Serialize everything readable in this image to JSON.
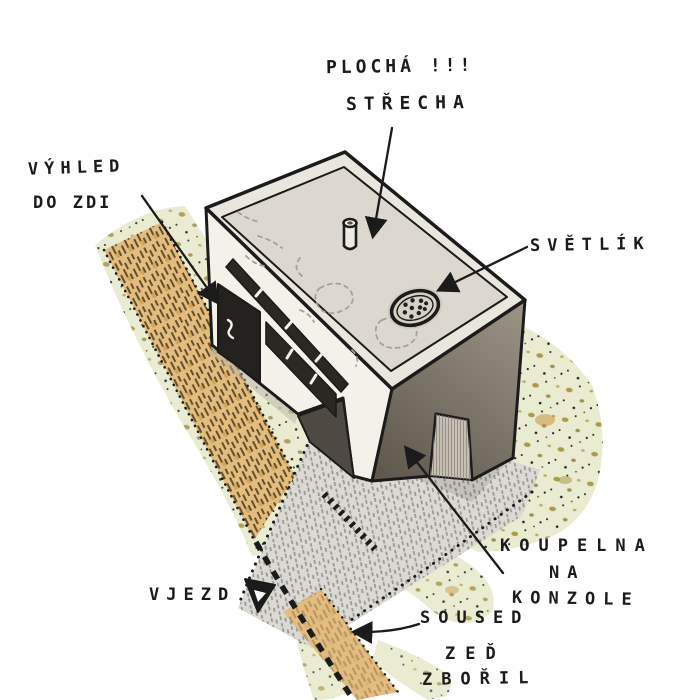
{
  "illustration": {
    "description": "hand-drawn axonometric sketch of a flat-roofed house",
    "labels": {
      "flat_roof": {
        "line1": "PLOCHÁ !!!",
        "line2": "STŘECHA"
      },
      "view_into_wall": {
        "line1": "VÝHLED",
        "line2": "DO ZDI"
      },
      "skylight": {
        "text": "SVĚTLÍK"
      },
      "bathroom": {
        "line1": "KOUPELNA",
        "line2": "NA",
        "line3": "KONZOLE"
      },
      "entrance": {
        "text": "VJEZD"
      },
      "neighbor": {
        "line1": "SOUSED",
        "line2": "ZEĎ",
        "line3": "ZBOŘIL"
      }
    },
    "colors": {
      "ink": "#1b1b1b",
      "roof_top": "#dcd8cf",
      "roof_parapet": "#e9e6de",
      "facade_light": "#f3f1ea",
      "facade_dark_top": "#9c9486",
      "facade_dark_bottom": "#5d574c",
      "opening_shadow": "#4e4a43",
      "passage_reveal": "#c7c1b4",
      "driveway": "#dbd9d3",
      "wall_ochre": "#e3bc80",
      "wall_ochre_dark": "#c3913f",
      "ground_green": "#eaecd2",
      "speckle_olive": "#8f823c",
      "window_glass": "#2a2823",
      "paper": "#ffffff"
    }
  }
}
